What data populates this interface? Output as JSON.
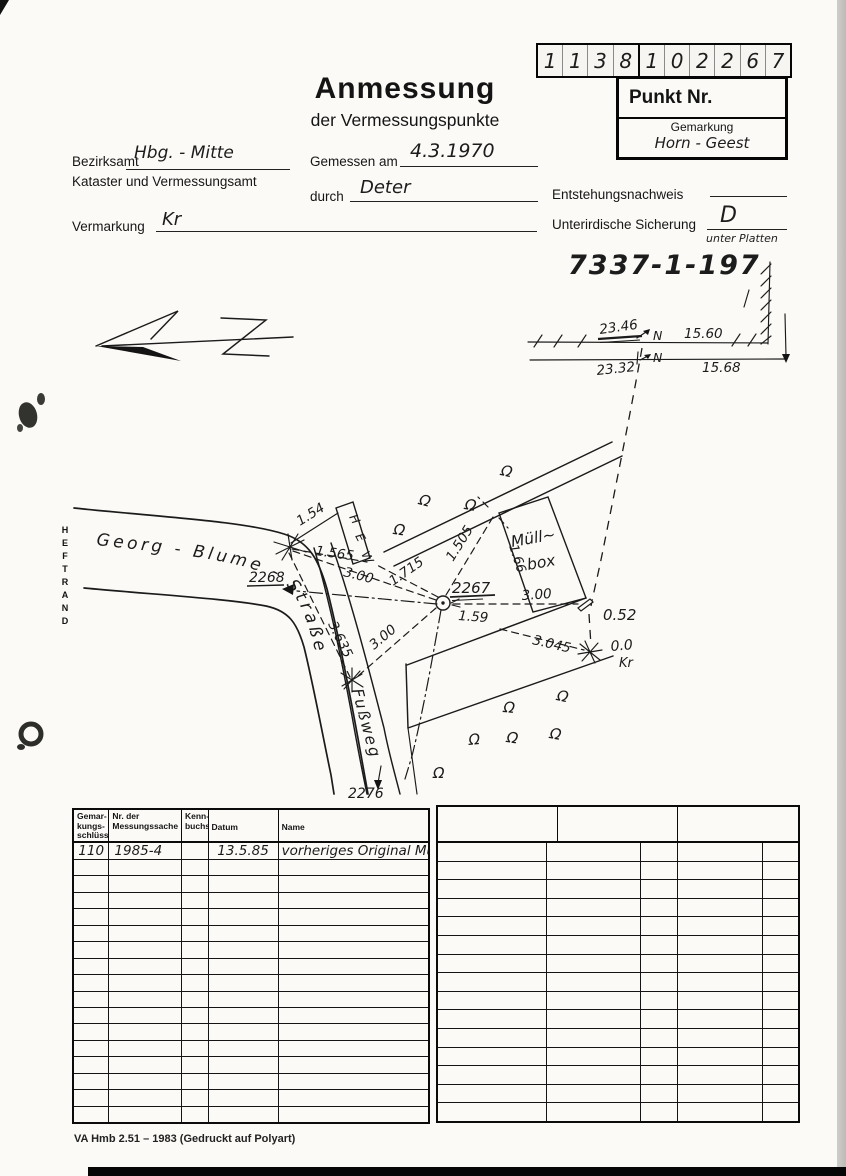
{
  "header": {
    "digits": [
      "1",
      "1",
      "3",
      "8",
      "1",
      "0",
      "2",
      "2",
      "6",
      "7"
    ],
    "punkt_nr_label": "Punkt Nr.",
    "gemarkung_label": "Gemarkung",
    "gemarkung_value": "Horn - Geest",
    "title": "Anmessung",
    "subtitle": "der Vermessungspunkte",
    "bezirksamt_label": "Bezirksamt",
    "bezirksamt_value": "Hbg. - Mitte",
    "kataster_label": "Kataster und Vermessungsamt",
    "gemessen_label": "Gemessen am",
    "gemessen_value": "4.3.1970",
    "durch_label": "durch",
    "durch_value": "Deter",
    "entstehung_label": "Entstehungsnachweis",
    "vermarkung_label": "Vermarkung",
    "vermarkung_value": "Kr",
    "sicherung_label": "Unterirdische Sicherung",
    "sicherung_value": "D",
    "sicherung_note": "unter Platten",
    "file_number": "7337-1-197"
  },
  "sketch": {
    "heftrand": "HEFTRAND",
    "street_name": "Georg - Blume - Straße",
    "fussweg_label": "Fußweg",
    "hew_letters": [
      "H",
      "E",
      "W"
    ],
    "muellbox_line1": "Müll~",
    "muellbox_line2": "box",
    "omega": "Ω",
    "north_letter_1": "N",
    "north_letter_2": "N",
    "dim_2346": "23.46",
    "dim_1560": "15.60",
    "dim_2332": "23.32",
    "dim_1568": "15.68",
    "p2267": "2267",
    "p2268": "2268",
    "p2276": "2276",
    "m_154": "1.54",
    "m_1565": "1.565",
    "m_300_a": "3.00",
    "m_3635": "3.635",
    "m_1715": "1.715",
    "m_1505": "1.505",
    "m_166": "1.66",
    "m_159": "1.59",
    "m_300_b": "3.00",
    "m_300_c": "3.00",
    "m_3045": "3.045",
    "m_052": "0.52",
    "m_00": "0.0",
    "m_kr": "Kr"
  },
  "table_left": {
    "headers": [
      "Gemar-\nkungs-\nschlüssel",
      "Nr. der\nMessungssache",
      "Kenn-\nbuchst.",
      "Datum",
      "Name"
    ],
    "row1": [
      "110",
      "1985-4",
      "",
      "13.5.85",
      "vorheriges Original Mü"
    ],
    "empty_row_count": 16
  },
  "table_right": {
    "empty_row_count": 15
  },
  "footer": {
    "imprint": "VA Hmb 2.51 – 1983 (Gedruckt auf Polyart)"
  }
}
